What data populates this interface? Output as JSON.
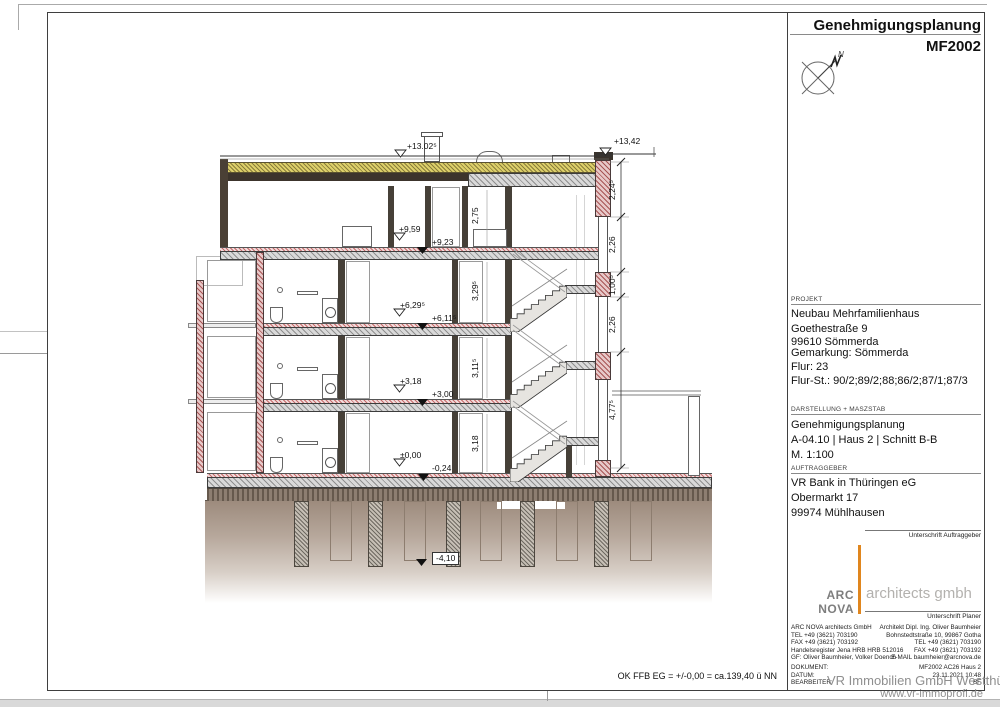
{
  "sheet": {
    "title": "Genehmigungsplanung",
    "code": "MF2002",
    "bottom_note": "OK FFB EG = +/-0,00 = ca.139,40 ü NN",
    "watermark_line1": "VR Immobilien GmbH Westthüringen",
    "watermark_line2": "www.vr-immoprofi.de"
  },
  "titleblock": {
    "projekt_label": "PROJEKT",
    "projekt_lines": [
      "Neubau Mehrfamilienhaus",
      "Goethestraße 9",
      "99610 Sömmerda",
      "Gemarkung: Sömmerda",
      "Flur: 23",
      "Flur-St.: 90/2;89/2;88;86/2;87/1;87/3"
    ],
    "darstellung_label": "DARSTELLUNG + MASZSTAB",
    "darstellung_lines": [
      "Genehmigungsplanung",
      "A-04.10 | Haus 2 | Schnitt B-B",
      "M. 1:100"
    ],
    "auftraggeber_label": "AUFTRAGGEBER",
    "auftraggeber_lines": [
      "VR Bank in Thüringen eG",
      "Obermarkt 17",
      "99974 Mühlhausen"
    ],
    "signature_client": "Unterschrift Auftraggeber",
    "signature_planner": "Unterschrift Planer",
    "logo_left": "ARC NOVA",
    "logo_right": "architects gmbh",
    "logo_accent_color": "#e0861e",
    "contact_left": [
      "ARC NOVA architects GmbH",
      "TEL   +49 (3621) 703190",
      "FAX   +49 (3621) 703192",
      "Handelsregister Jena HRB HRB 512016",
      "GF: Oliver Baumheier, Volker Doench"
    ],
    "contact_right": [
      "Architekt Dipl. Ing. Oliver Baumheier",
      "Bohnstedtstraße 10, 99867 Gotha",
      "TEL   +49 (3621) 703190",
      "FAX   +49 (3621) 703192",
      "E-MAIL baumheier@arcnova.de"
    ],
    "doc_rows": [
      {
        "label": "DOKUMENT:",
        "value": "MF2002 AC26 Haus 2"
      },
      {
        "label": "DATUM:",
        "value": "23.11.2021 10:48"
      },
      {
        "label": "BEARBEITER:",
        "value": "BF"
      }
    ]
  },
  "compass": {
    "north_label": "N"
  },
  "drawing": {
    "elevations": {
      "roof_mid": "+13.02⁵",
      "roof_right": "+13,42",
      "l3_raw": "+9,59",
      "l3_ffb": "+9,23",
      "l2_raw": "+6,29⁵",
      "l2_ffb": "+6,11⁵",
      "l1_raw": "+3,18",
      "l1_ffb": "+3,00",
      "eg_zero": "±0,00",
      "eg_raw": "-0,24",
      "foundation": "-4,10"
    },
    "room_heights": {
      "attic": "2,75",
      "level2": "3,29⁵",
      "level1": "3,11⁵",
      "eg": "3,18"
    },
    "dim_chain": [
      "2,24⁵",
      "2,26",
      "1,00⁵",
      "2,26",
      "4,77⁵"
    ]
  }
}
